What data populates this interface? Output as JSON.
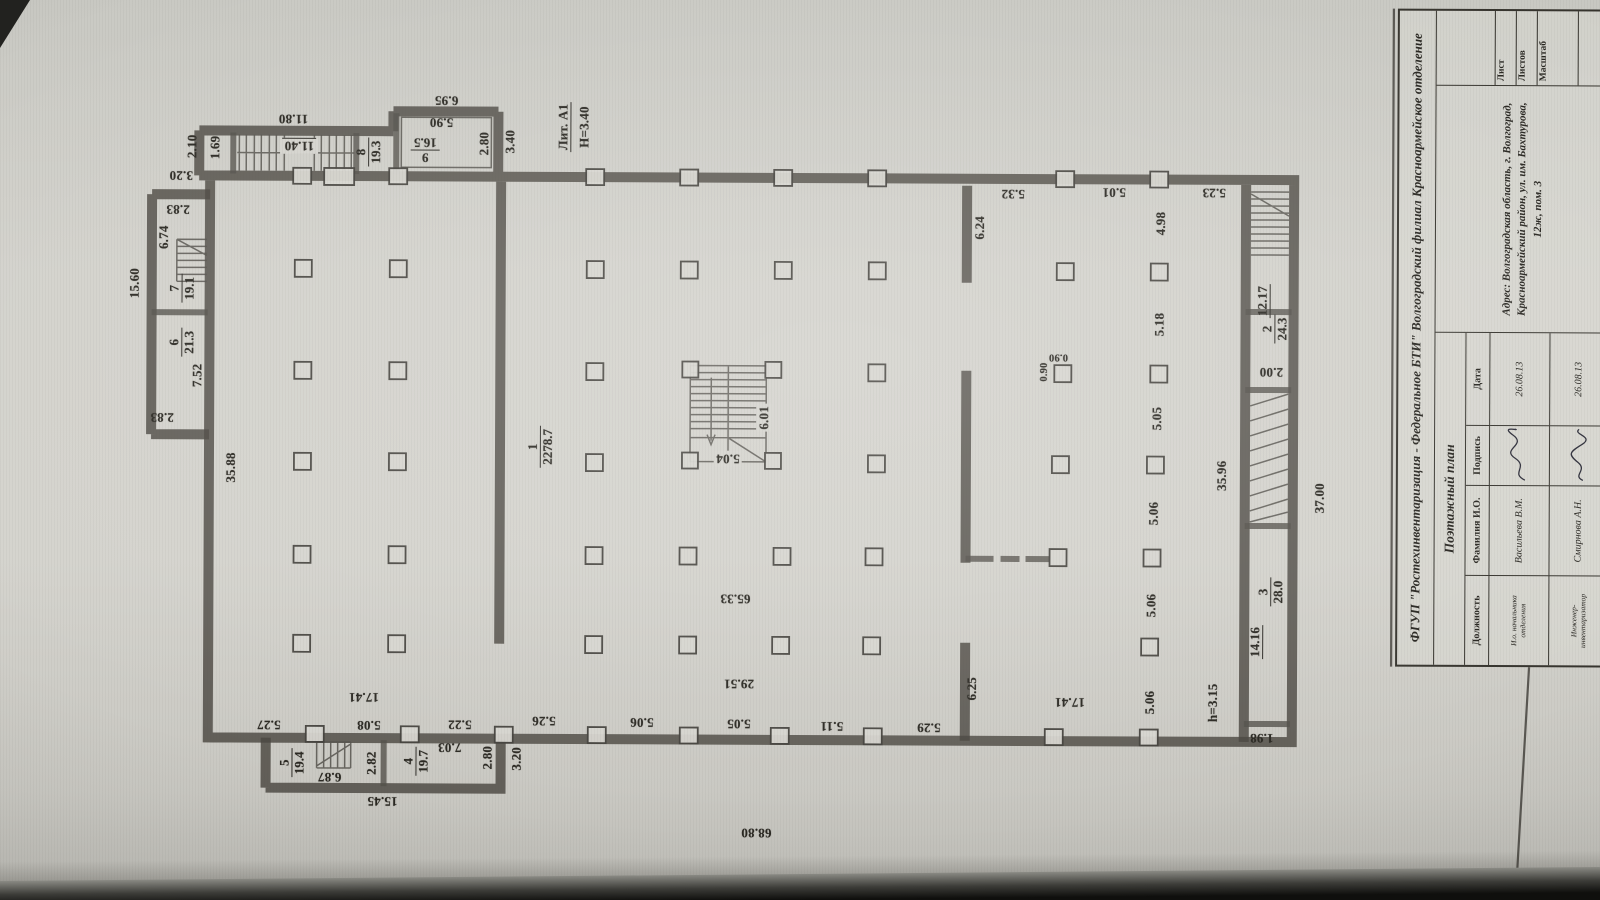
{
  "palette": {
    "paper": "#d5d4ce",
    "ink": "#2e2c27",
    "bezel": "#141412"
  },
  "title_block": {
    "org": "ФГУП \"Ростехинвентаризация - Федеральное БТИ\" Волгоградский филиал Красноармейское отделение",
    "doc_title": "Поэтажный план",
    "table": {
      "headers": [
        "Должность",
        "Фамилия И.О.",
        "Подпись",
        "Дата"
      ],
      "rows": [
        {
          "role": "И.о. начальника отделения",
          "name": "Васильева В.М.",
          "date": "26.08.13"
        },
        {
          "role": "Инженер-инвентаризатор",
          "name": "Смирнова А.Н.",
          "date": "26.08.13"
        }
      ]
    },
    "address": "Адрес: Волгоградская область, г. Волгоград, Красноармейский район, ул. им. Бахтурова, 12ж, пом. 3",
    "sheet": {
      "list": "Лист",
      "sheets": "Листов",
      "scale": "Масштаб"
    }
  },
  "plan": {
    "dims": [
      {
        "t": "15.60",
        "x": 134,
        "y": 286,
        "r": -90
      },
      {
        "t": "2.10",
        "x": 191,
        "y": 149,
        "r": -90
      },
      {
        "t": "1.69",
        "x": 214,
        "y": 150,
        "r": -90
      },
      {
        "t": "11.80",
        "x": 292,
        "y": 121,
        "r": 180
      },
      {
        "t": "11.40",
        "x": 298,
        "y": 148,
        "r": 180,
        "u": true,
        "b": true
      },
      {
        "t": "5.90",
        "x": 440,
        "y": 124,
        "r": 180
      },
      {
        "t": "6.95",
        "x": 445,
        "y": 102,
        "r": 180
      },
      {
        "t": "2.80",
        "x": 483,
        "y": 145,
        "r": -90
      },
      {
        "t": "3.40",
        "x": 509,
        "y": 143,
        "r": -90
      },
      {
        "t": "Лит. А1",
        "x": 562,
        "y": 128,
        "r": -90,
        "u": true
      },
      {
        "t": "Н=3.40",
        "x": 583,
        "y": 128,
        "r": -90
      },
      {
        "t": "3.20",
        "x": 180,
        "y": 178,
        "r": 180
      },
      {
        "t": "2.83",
        "x": 177,
        "y": 212,
        "r": 180
      },
      {
        "t": "6.74",
        "x": 163,
        "y": 240,
        "r": -90
      },
      {
        "t": "7.52",
        "x": 197,
        "y": 378,
        "r": -90
      },
      {
        "t": "2.83",
        "x": 162,
        "y": 420,
        "r": 180
      },
      {
        "t": "35.88",
        "x": 231,
        "y": 470,
        "r": -90
      },
      {
        "t": "5.04",
        "x": 728,
        "y": 459,
        "r": 180,
        "b": true
      },
      {
        "t": "6.01",
        "x": 764,
        "y": 418,
        "r": -90,
        "b": true
      },
      {
        "t": "65.33",
        "x": 736,
        "y": 599,
        "r": 180
      },
      {
        "t": "29.51",
        "x": 740,
        "y": 684,
        "r": 180
      },
      {
        "t": "5.32",
        "x": 1012,
        "y": 193,
        "r": 180
      },
      {
        "t": "5.01",
        "x": 1113,
        "y": 191,
        "r": 180
      },
      {
        "t": "5.23",
        "x": 1213,
        "y": 191,
        "r": 180
      },
      {
        "t": "6.24",
        "x": 979,
        "y": 227,
        "r": -90
      },
      {
        "t": "4.98",
        "x": 1160,
        "y": 222,
        "r": -90
      },
      {
        "t": "5.18",
        "x": 1159,
        "y": 323,
        "r": -90
      },
      {
        "t": "5.05",
        "x": 1157,
        "y": 417,
        "r": -90
      },
      {
        "t": "5.06",
        "x": 1154,
        "y": 512,
        "r": -90
      },
      {
        "t": "5.06",
        "x": 1152,
        "y": 604,
        "r": -90
      },
      {
        "t": "5.06",
        "x": 1151,
        "y": 701,
        "r": -90
      },
      {
        "t": "0.90",
        "x": 1058,
        "y": 356,
        "r": 180,
        "cls": "small"
      },
      {
        "t": "0.90",
        "x": 1044,
        "y": 371,
        "r": -90,
        "cls": "small"
      },
      {
        "t": "6.25",
        "x": 973,
        "y": 688,
        "r": -90
      },
      {
        "t": "12.17",
        "x": 1262,
        "y": 299,
        "r": -90,
        "u": true
      },
      {
        "t": "2.00",
        "x": 1271,
        "y": 370,
        "r": 180
      },
      {
        "t": "14.16",
        "x": 1256,
        "y": 640,
        "r": -90,
        "u": true
      },
      {
        "t": "h=3.15",
        "x": 1214,
        "y": 701,
        "r": -90
      },
      {
        "t": "1.98",
        "x": 1263,
        "y": 736,
        "r": 180
      },
      {
        "t": "35.96",
        "x": 1222,
        "y": 474,
        "r": -90
      },
      {
        "t": "37.00",
        "x": 1320,
        "y": 496,
        "r": -90
      },
      {
        "t": "5.27",
        "x": 270,
        "y": 727,
        "r": 180
      },
      {
        "t": "5.08",
        "x": 370,
        "y": 727,
        "r": 180
      },
      {
        "t": "5.22",
        "x": 461,
        "y": 726,
        "r": 180
      },
      {
        "t": "5.26",
        "x": 545,
        "y": 722,
        "r": 180
      },
      {
        "t": "5.06",
        "x": 643,
        "y": 723,
        "r": 180
      },
      {
        "t": "5.05",
        "x": 740,
        "y": 724,
        "r": 180
      },
      {
        "t": "5.11",
        "x": 833,
        "y": 726,
        "r": 180
      },
      {
        "t": "5.29",
        "x": 930,
        "y": 727,
        "r": 180
      },
      {
        "t": "17.41",
        "x": 365,
        "y": 699,
        "r": 180
      },
      {
        "t": "17.41",
        "x": 1071,
        "y": 701,
        "r": 180
      },
      {
        "t": "6.87",
        "x": 331,
        "y": 779,
        "r": 180
      },
      {
        "t": "2.82",
        "x": 373,
        "y": 765,
        "r": -90
      },
      {
        "t": "7.03",
        "x": 451,
        "y": 749,
        "r": 180
      },
      {
        "t": "2.80",
        "x": 489,
        "y": 759,
        "r": -90
      },
      {
        "t": "3.20",
        "x": 518,
        "y": 760,
        "r": -90
      },
      {
        "t": "15.45",
        "x": 384,
        "y": 803,
        "r": 180
      },
      {
        "t": "68.80",
        "x": 758,
        "y": 833,
        "r": 180
      }
    ],
    "rooms": [
      {
        "num": "1",
        "den": "2278.7",
        "x": 540,
        "y": 448,
        "r": -90
      },
      {
        "num": "2",
        "den": "24.3",
        "x": 1274,
        "y": 327,
        "r": -90
      },
      {
        "num": "3",
        "den": "28.0",
        "x": 1271,
        "y": 590,
        "r": -90
      },
      {
        "num": "4",
        "den": "19.7",
        "x": 417,
        "y": 763,
        "r": -90
      },
      {
        "num": "5",
        "den": "19.4",
        "x": 293,
        "y": 765,
        "r": -90
      },
      {
        "num": "6",
        "den": "21.3",
        "x": 181,
        "y": 345,
        "r": -90
      },
      {
        "num": "7",
        "den": "19.1",
        "x": 181,
        "y": 291,
        "r": -90
      },
      {
        "num": "8",
        "den": "19.3",
        "x": 367,
        "y": 154,
        "r": -90
      },
      {
        "num": "9",
        "den": "16.5",
        "x": 424,
        "y": 152,
        "r": 180
      }
    ]
  }
}
